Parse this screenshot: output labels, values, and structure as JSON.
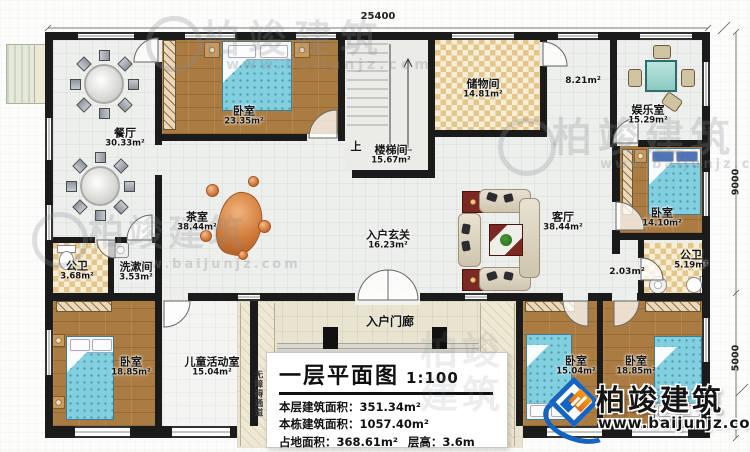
{
  "plan": {
    "dimensions": {
      "top_width": "25400",
      "right_upper": "9000",
      "right_lower": "5000"
    },
    "rooms": [
      {
        "name": "餐厅",
        "area": "30.33m²"
      },
      {
        "name": "卧室",
        "area": "23.35m²"
      },
      {
        "name": "楼梯间",
        "area": "15.67m²"
      },
      {
        "name": "储物间",
        "area": "14.81m²"
      },
      {
        "name": "娱乐室",
        "area": "15.29m²"
      },
      {
        "name": "卧室",
        "area": "14.10m²"
      },
      {
        "name": "公卫",
        "area": "5.19m²"
      },
      {
        "name": "茶室",
        "area": "38.44m²"
      },
      {
        "name": "入户玄关",
        "area": "16.23m²"
      },
      {
        "name": "客厅",
        "area": "38.44m²"
      },
      {
        "name": "公卫",
        "area": "3.68m²"
      },
      {
        "name": "洗漱间",
        "area": "3.53m²"
      },
      {
        "name": "卧室",
        "area": "18.85m²"
      },
      {
        "name": "儿童活动室",
        "area": "15.04m²"
      },
      {
        "name": "卧室",
        "area": "15.04m²"
      },
      {
        "name": "卧室",
        "area": "18.85m²"
      }
    ],
    "annotations": {
      "hall_area": "8.21m²",
      "vestibule_area": "2.03m²",
      "stairs_up": "上",
      "entry_porch": "入户门廊",
      "ramp": "无障碍通道"
    }
  },
  "title_block": {
    "title": "一层平面图",
    "scale": "1:100",
    "row1": "本层建筑面积：351.34m²",
    "row2": "本栋建筑面积：1057.40m²",
    "row3": "占地面积：368.61m²",
    "row3b": "层高：3.6m"
  },
  "brand": {
    "name": "柏竣建筑",
    "url": "www.baijunjz.com"
  },
  "watermark": {
    "name": "柏竣建筑",
    "url": "www.baijunjz.com"
  },
  "icons": [
    "bed",
    "dining-table",
    "sofa",
    "coffee-table",
    "tea-root-table",
    "game-table",
    "toilet",
    "sink",
    "stairs",
    "wardrobe",
    "column",
    "door-arc",
    "window"
  ],
  "colors": {
    "wall": "#1b1b1b",
    "wood_floor": "#ab7c42",
    "tile_floor": "#edefec",
    "check_floor": "#e2c68c",
    "bed": "#82cfe0",
    "accent_table": "#7a2a22",
    "brand_blue": "#1565c0",
    "brand_orange": "#f08418"
  }
}
